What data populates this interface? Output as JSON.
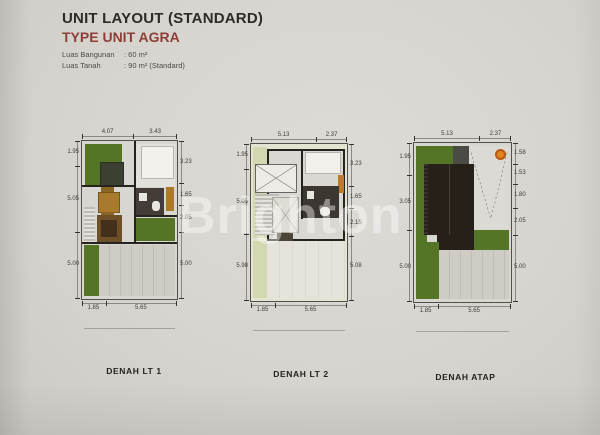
{
  "header": {
    "title": "UNIT LAYOUT (STANDARD)",
    "subtitle": "TYPE UNIT AGRA",
    "specs": [
      {
        "label": "Luas Bangunan",
        "value": ": 60 m²"
      },
      {
        "label": "Luas Tanah",
        "value": ": 90 m² (Standard)"
      }
    ]
  },
  "watermark": {
    "text": "Brighton"
  },
  "colors": {
    "paper": "#d7d4cf",
    "accent_red": "#8d3f36",
    "garden_green": "#547426",
    "roof_dark": "#262019",
    "wall": "#26231f",
    "driveway_gray": "#ccc9c3",
    "water_tank_orange": "#e0841f"
  },
  "plans": [
    {
      "label": "DENAH LT 1",
      "dims": {
        "top": [
          "4.07",
          "3.43"
        ],
        "left": [
          "1.95",
          "5.05",
          "5.00"
        ],
        "right": [
          "3.23",
          "1.65",
          "2.05",
          "5.00"
        ],
        "bottom": [
          "1.85",
          "5.65"
        ]
      }
    },
    {
      "label": "DENAH LT 2",
      "dims": {
        "top": [
          "5.13",
          "2.37"
        ],
        "left": [
          "1.95",
          "5.05",
          "5.98"
        ],
        "right": [
          "3.23",
          "1.65",
          "2.15",
          "5.08"
        ],
        "bottom": [
          "1.85",
          "5.65"
        ]
      }
    },
    {
      "label": "DENAH ATAP",
      "dims": {
        "top": [
          "5.13",
          "2.37"
        ],
        "left": [
          "1.95",
          "3.05",
          "5.00"
        ],
        "right": [
          "1.58",
          "1.53",
          "1.80",
          "2.05",
          "5.00"
        ],
        "bottom": [
          "1.85",
          "5.65"
        ]
      }
    }
  ]
}
